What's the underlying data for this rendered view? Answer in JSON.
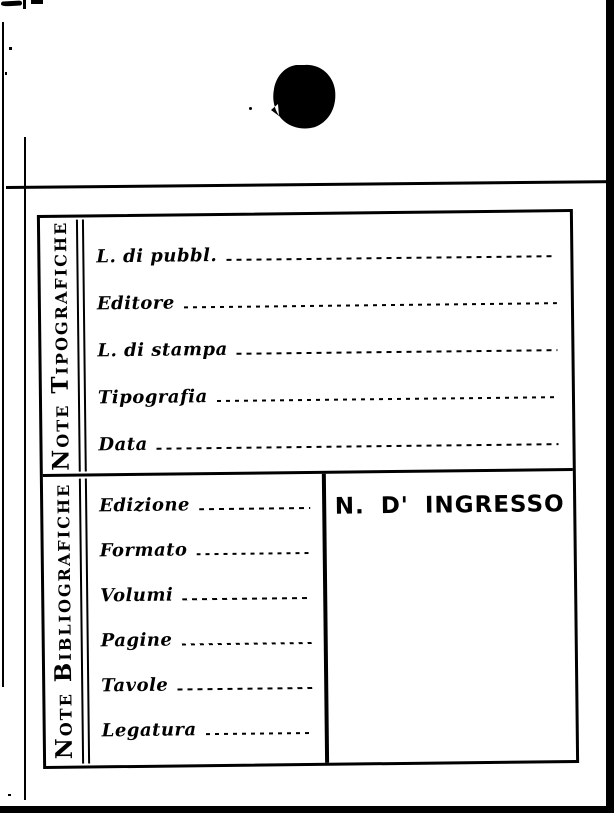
{
  "colors": {
    "ink": "#000000",
    "paper": "#ffffff"
  },
  "card": {
    "sections": [
      {
        "side_label": "Note Tipografiche",
        "fields": [
          {
            "label": "L. di pubbl.",
            "value": ""
          },
          {
            "label": "Editore",
            "value": ""
          },
          {
            "label": "L. di stampa",
            "value": ""
          },
          {
            "label": "Tipografia",
            "value": ""
          },
          {
            "label": "Data",
            "value": ""
          }
        ]
      },
      {
        "side_label": "Note Bibliografiche",
        "fields": [
          {
            "label": "Edizione",
            "value": ""
          },
          {
            "label": "Formato",
            "value": ""
          },
          {
            "label": "Volumi",
            "value": ""
          },
          {
            "label": "Pagine",
            "value": ""
          },
          {
            "label": "Tavole",
            "value": ""
          },
          {
            "label": "Legatura",
            "value": ""
          }
        ],
        "ingresso_label": "N. D' INGRESSO"
      }
    ]
  }
}
